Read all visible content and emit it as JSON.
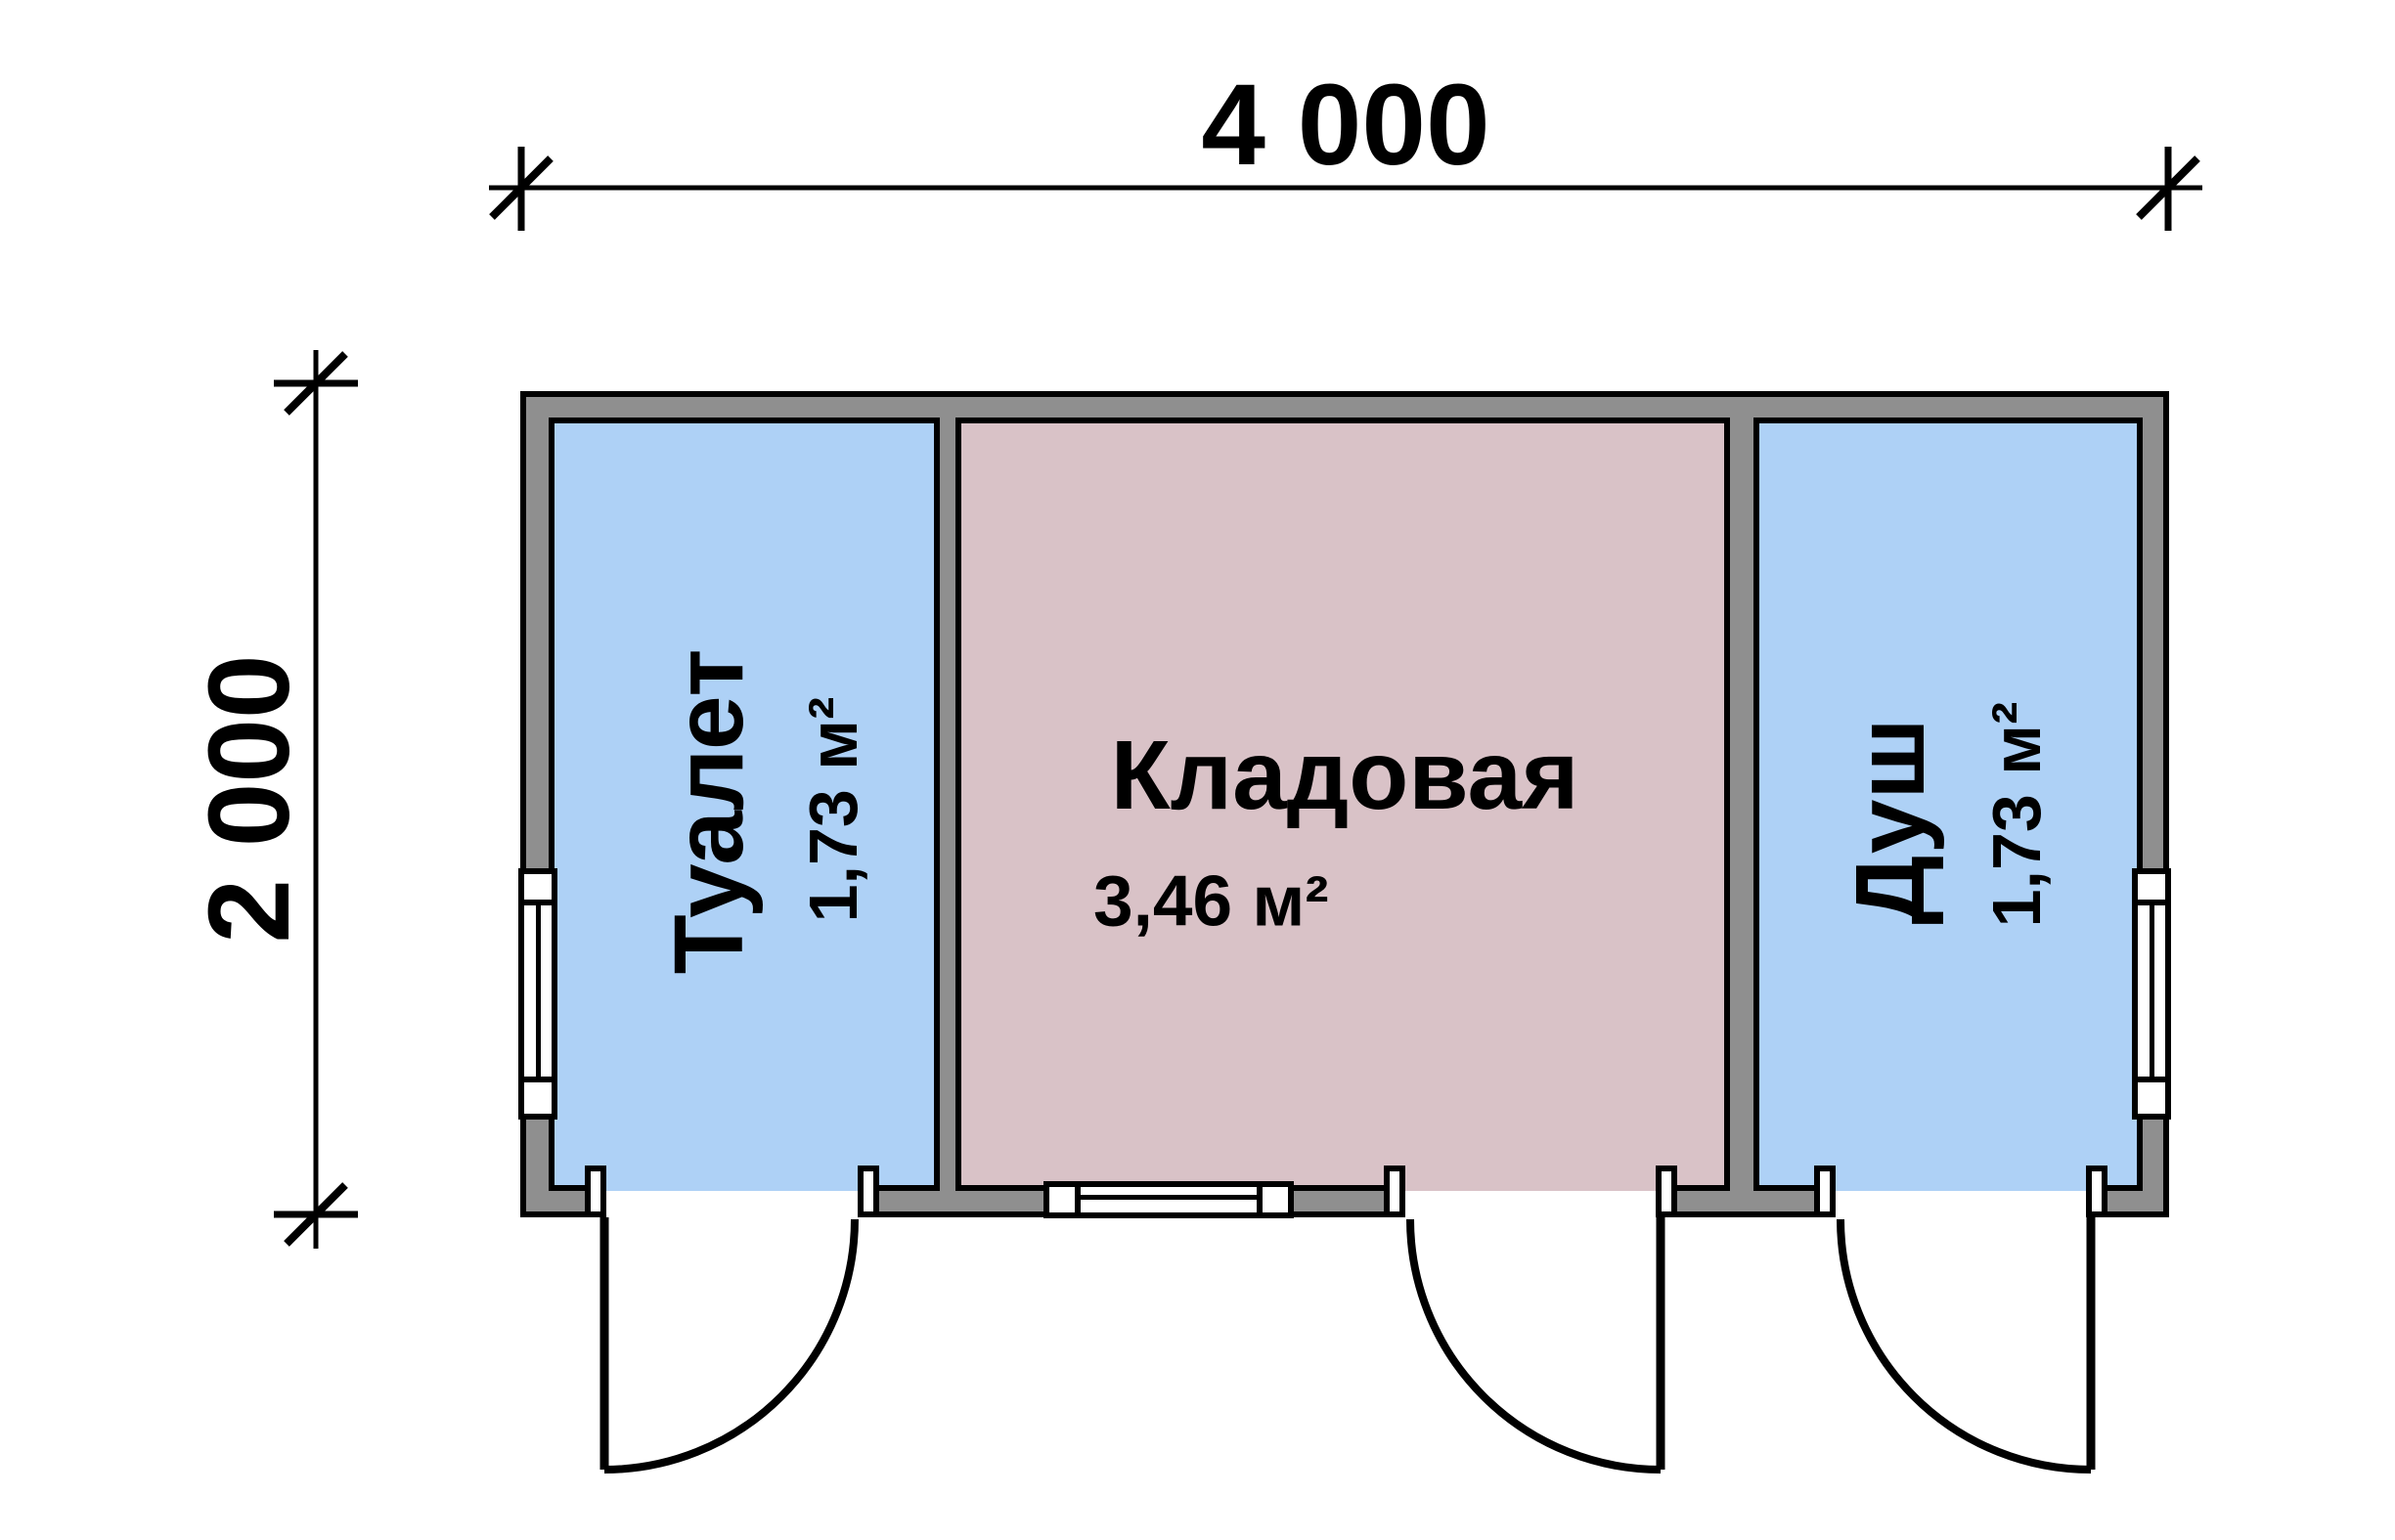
{
  "plan": {
    "dimensions": {
      "width_label": "4 000",
      "height_label": "2 000"
    },
    "rooms": {
      "toilet": {
        "name": "Туалет",
        "area": "1,73 м²"
      },
      "storage": {
        "name": "Кладовая",
        "area": "3,46 м²"
      },
      "shower": {
        "name": "Душ",
        "area": "1,73 м²"
      }
    },
    "colors": {
      "wall_gray": "#8f8f8f",
      "room_blue": "#aed1f6",
      "room_pink": "#d9c2c7",
      "line_black": "#000000",
      "window_white": "#ffffff"
    }
  }
}
